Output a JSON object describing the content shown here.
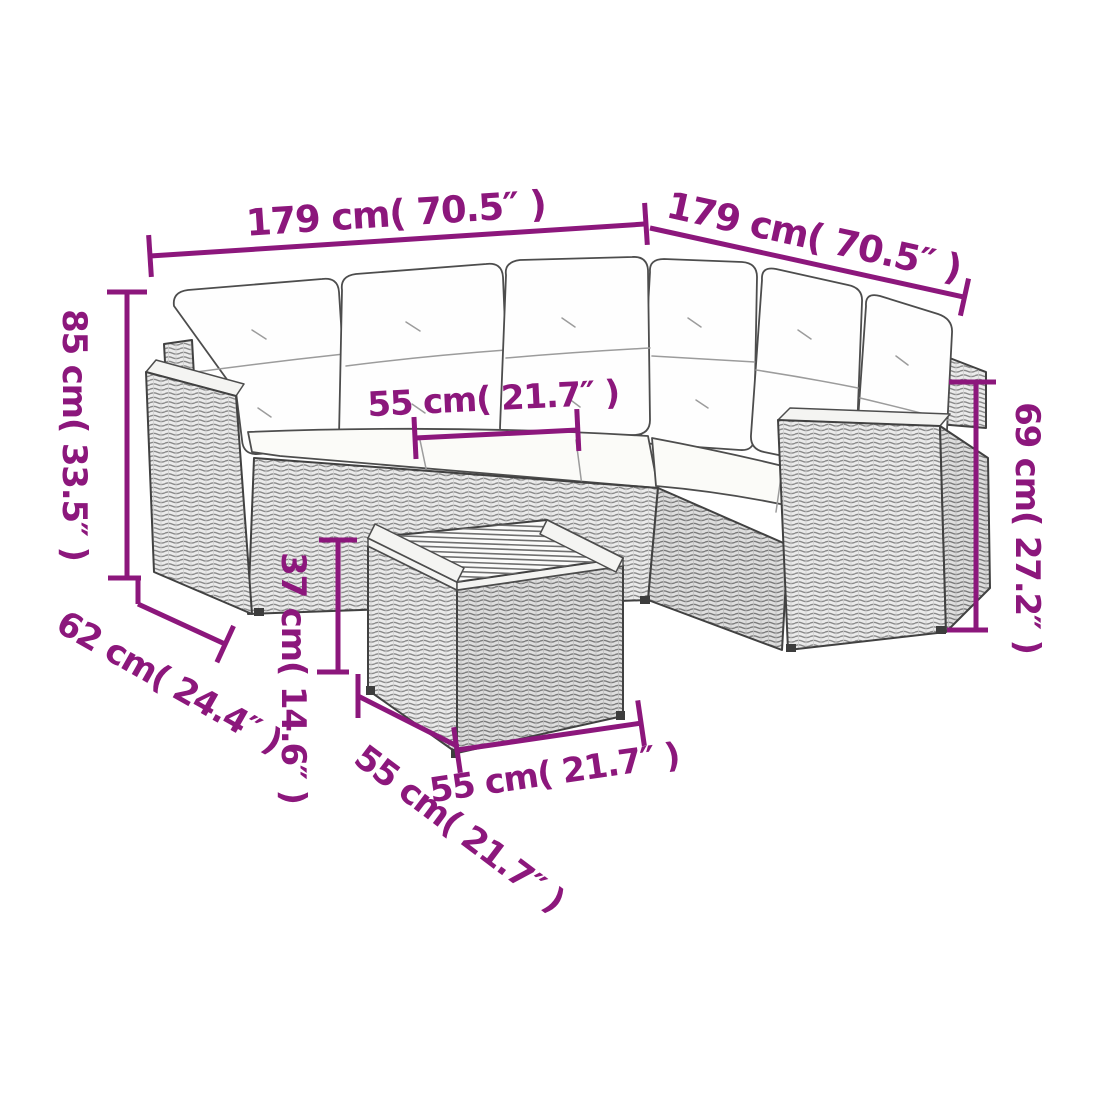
{
  "diagram": {
    "type": "product-dimension-diagram",
    "subject": "rattan corner sofa set with cushions and coffee table",
    "colors": {
      "dimension_accent": "#8C177C",
      "line_art": "#414141",
      "wicker_fill": "#ebebeb",
      "cushion_fill": "#fefefe",
      "background": "#ffffff"
    },
    "dimensions": {
      "sofa_left_width": "179 cm( 70.5″ )",
      "sofa_right_width": "179 cm( 70.5″ )",
      "back_height": "85 cm( 33.5″ )",
      "seat_width": "55 cm( 21.7″ )",
      "arm_height": "69 cm( 27.2″ )",
      "seat_depth": "62 cm( 24.4″ )",
      "table_height": "37 cm( 14.6″ )",
      "table_depth": "55 cm( 21.7″ )",
      "table_width": "55 cm( 21.7″ )"
    }
  }
}
